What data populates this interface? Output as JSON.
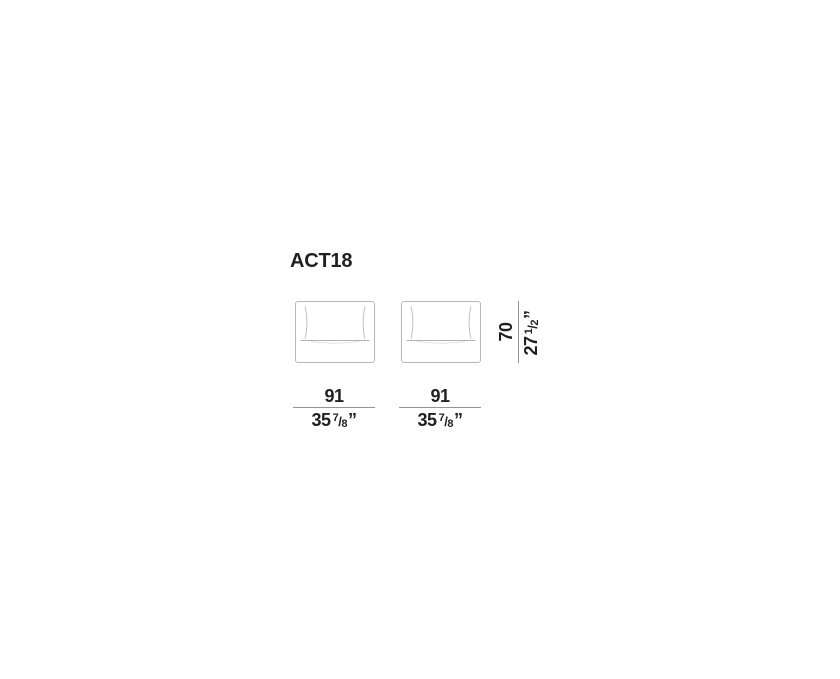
{
  "title": "ACT18",
  "colors": {
    "text": "#231f20",
    "furniture_outline": "#b7b7b7",
    "cushion_line": "#bfbfbf",
    "seat_line": "#b3b3b3",
    "dimension_line": "#939393",
    "background": "#ffffff"
  },
  "dimensions": {
    "width_unit_1": {
      "cm": "91",
      "inch_whole": "35",
      "inch_numerator": "7",
      "inch_slash": "/",
      "inch_denominator": "8",
      "inch_quote": "”"
    },
    "width_unit_2": {
      "cm": "91",
      "inch_whole": "35",
      "inch_numerator": "7",
      "inch_slash": "/",
      "inch_denominator": "8",
      "inch_quote": "”"
    },
    "height": {
      "cm": "70",
      "inch_whole": "27",
      "inch_numerator": "1",
      "inch_slash": "/",
      "inch_denominator": "2",
      "inch_quote": "”"
    }
  }
}
